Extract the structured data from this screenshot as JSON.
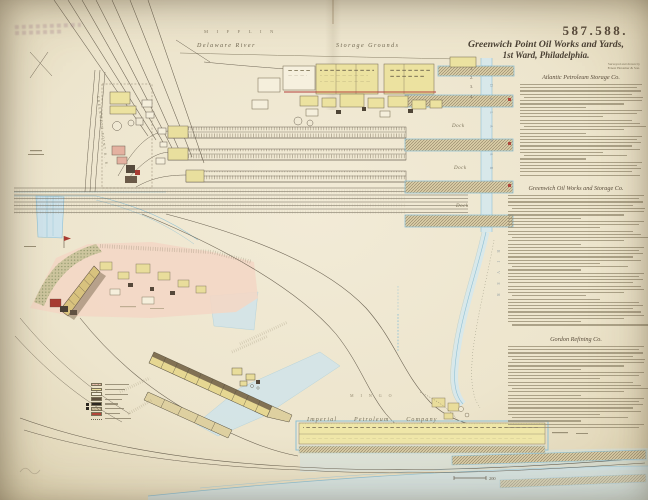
{
  "plate": {
    "number": "587.588."
  },
  "title": {
    "line1": "Greenwich Point Oil Works and Yards,",
    "line2": "1st Ward, Philadelphia."
  },
  "credits": [
    "Surveyed and drawn by",
    "Ernest Hexamer & Son."
  ],
  "sections": [
    {
      "heading": "Atlantic Petroleum Storage Co.",
      "lines": 29
    },
    {
      "heading": "Greenwich Oil Works and Storage Co.",
      "lines": 41
    },
    {
      "heading": "Gordon Refining Co.",
      "lines": 26
    }
  ],
  "map_labels": {
    "top_street": "MIFFLIN",
    "river_top": "Delaware River",
    "storage_grounds": "Storage Grounds",
    "dock": "Dock",
    "river_vertical_1": "DELAWARE",
    "river_vertical_2": "RIVER",
    "bottom_company": "Imperial Petroleum Company",
    "bottom_street": "MINGO",
    "track_label": "GREENWICH POINT R. R.",
    "scale": "200",
    "pier_numbers": [
      "1.",
      "2.",
      "3.",
      "4."
    ]
  },
  "legend": {
    "items": [
      {
        "color": "#eac1ae",
        "hatch": true,
        "marker": false,
        "label_w": 24
      },
      {
        "color": "#ece09c",
        "hatch": false,
        "marker": false,
        "label_w": 20
      },
      {
        "color": "#f3edda",
        "hatch": false,
        "marker": false,
        "label_w": 23
      },
      {
        "color": "#60513f",
        "hatch": false,
        "marker": false,
        "label_w": 17
      },
      {
        "color": "#2c2721",
        "hatch": false,
        "marker": true,
        "label_w": 13
      },
      {
        "color": "#cfc19e",
        "hatch": true,
        "marker": true,
        "label_w": 19
      },
      {
        "color": "#b2453a",
        "hatch": false,
        "marker": false,
        "label_w": 15
      },
      {
        "color": "#efe9d4",
        "hatch": false,
        "marker": false,
        "label_w": 26,
        "dotted": true
      }
    ]
  },
  "colors": {
    "paper": "#ece4cc",
    "water_edge": "#8fc0d4",
    "water_fill": "#cfe4ec",
    "building_yellow": "#ece2a0",
    "ground_pink": "#f3d7c5",
    "accent_red": "#b0473c",
    "ink": "#554c3d"
  }
}
